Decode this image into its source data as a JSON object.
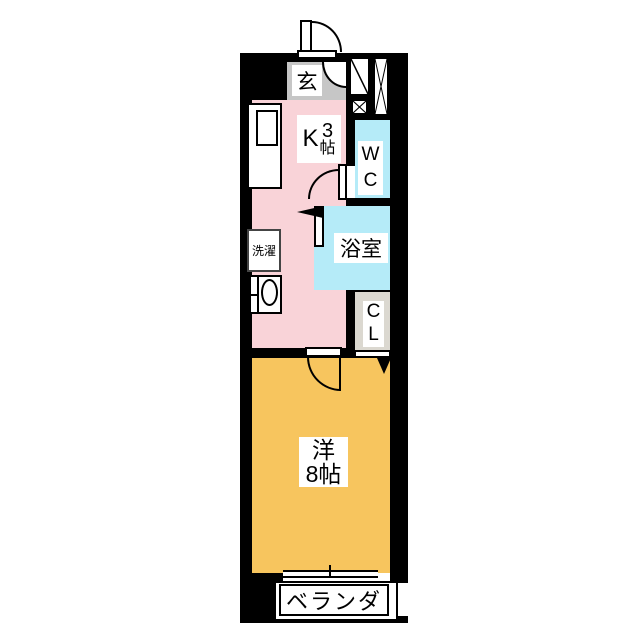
{
  "plan": {
    "type": "apartment-floor-plan",
    "colors": {
      "wall": "#000000",
      "background": "#FFFFFF",
      "kitchen_floor": "#F9D3D8",
      "main_room_floor": "#F7C55E",
      "wet_area_floor": "#B5EBF8",
      "genkan_floor": "#C6C6C6",
      "closet_floor": "#DBD8D0",
      "line": "#000000"
    },
    "rooms": {
      "genkan": {
        "label": "玄"
      },
      "kitchen": {
        "label": "K",
        "size_value": "3",
        "size_unit": "帖"
      },
      "wc": {
        "label_line1": "W",
        "label_line2": "C"
      },
      "bathroom": {
        "label": "浴室"
      },
      "laundry": {
        "label": "洗濯"
      },
      "closet": {
        "label_line1": "C",
        "label_line2": "L"
      },
      "main_room": {
        "label": "洋",
        "size": "8帖"
      },
      "veranda": {
        "label": "ベランダ"
      }
    }
  }
}
